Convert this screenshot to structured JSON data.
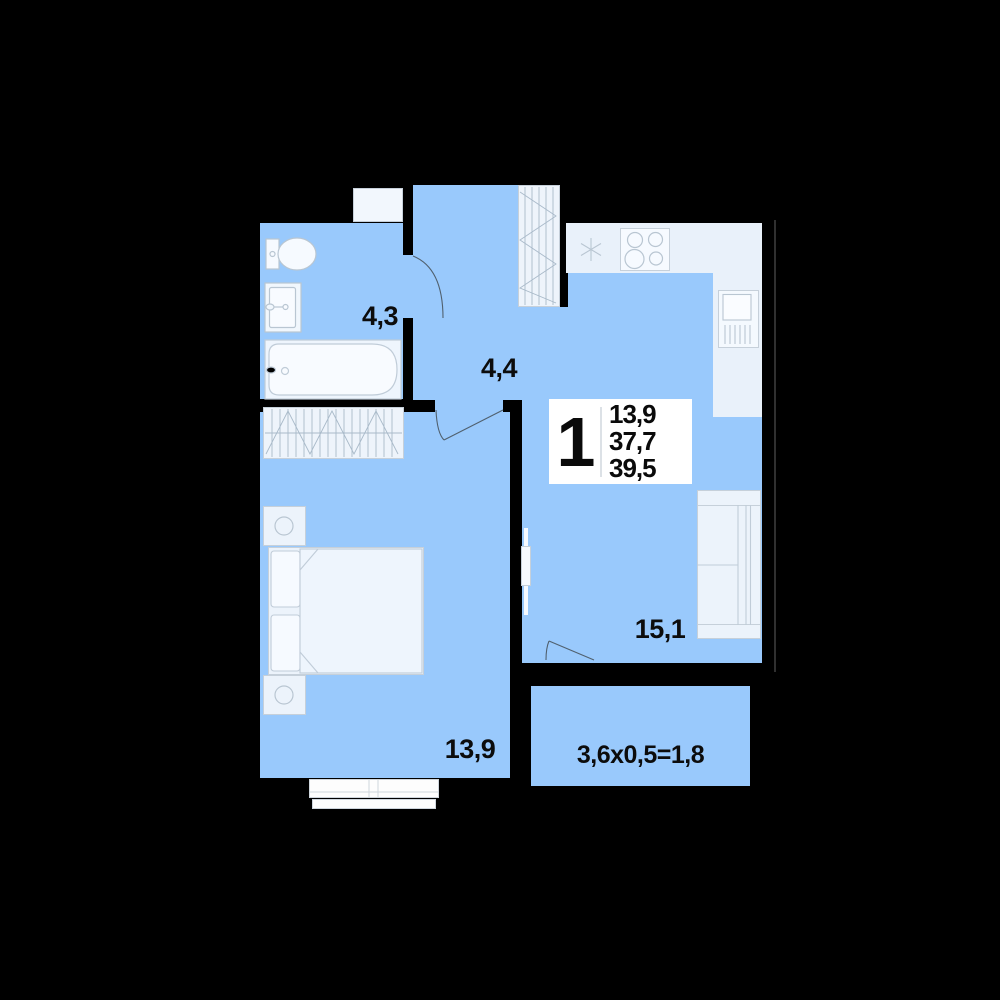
{
  "floorplan": {
    "info_block": {
      "rooms_count": "1",
      "area_line1": "13,9",
      "area_line2": "37,7",
      "area_line3": "39,5"
    },
    "room_labels": {
      "bathroom": "4,3",
      "hallway": "4,4",
      "bedroom": "13,9",
      "kitchen_living": "15,1",
      "balcony": "3,6x0,5=1,8"
    },
    "colors": {
      "background_wall": "#000000",
      "room_fill": "#99c9fc",
      "furniture_fill": "#ecf3fb",
      "furniture_stroke": "#c6d0da",
      "info_background": "#ffffff",
      "label_text": "#0c0c0c"
    }
  }
}
